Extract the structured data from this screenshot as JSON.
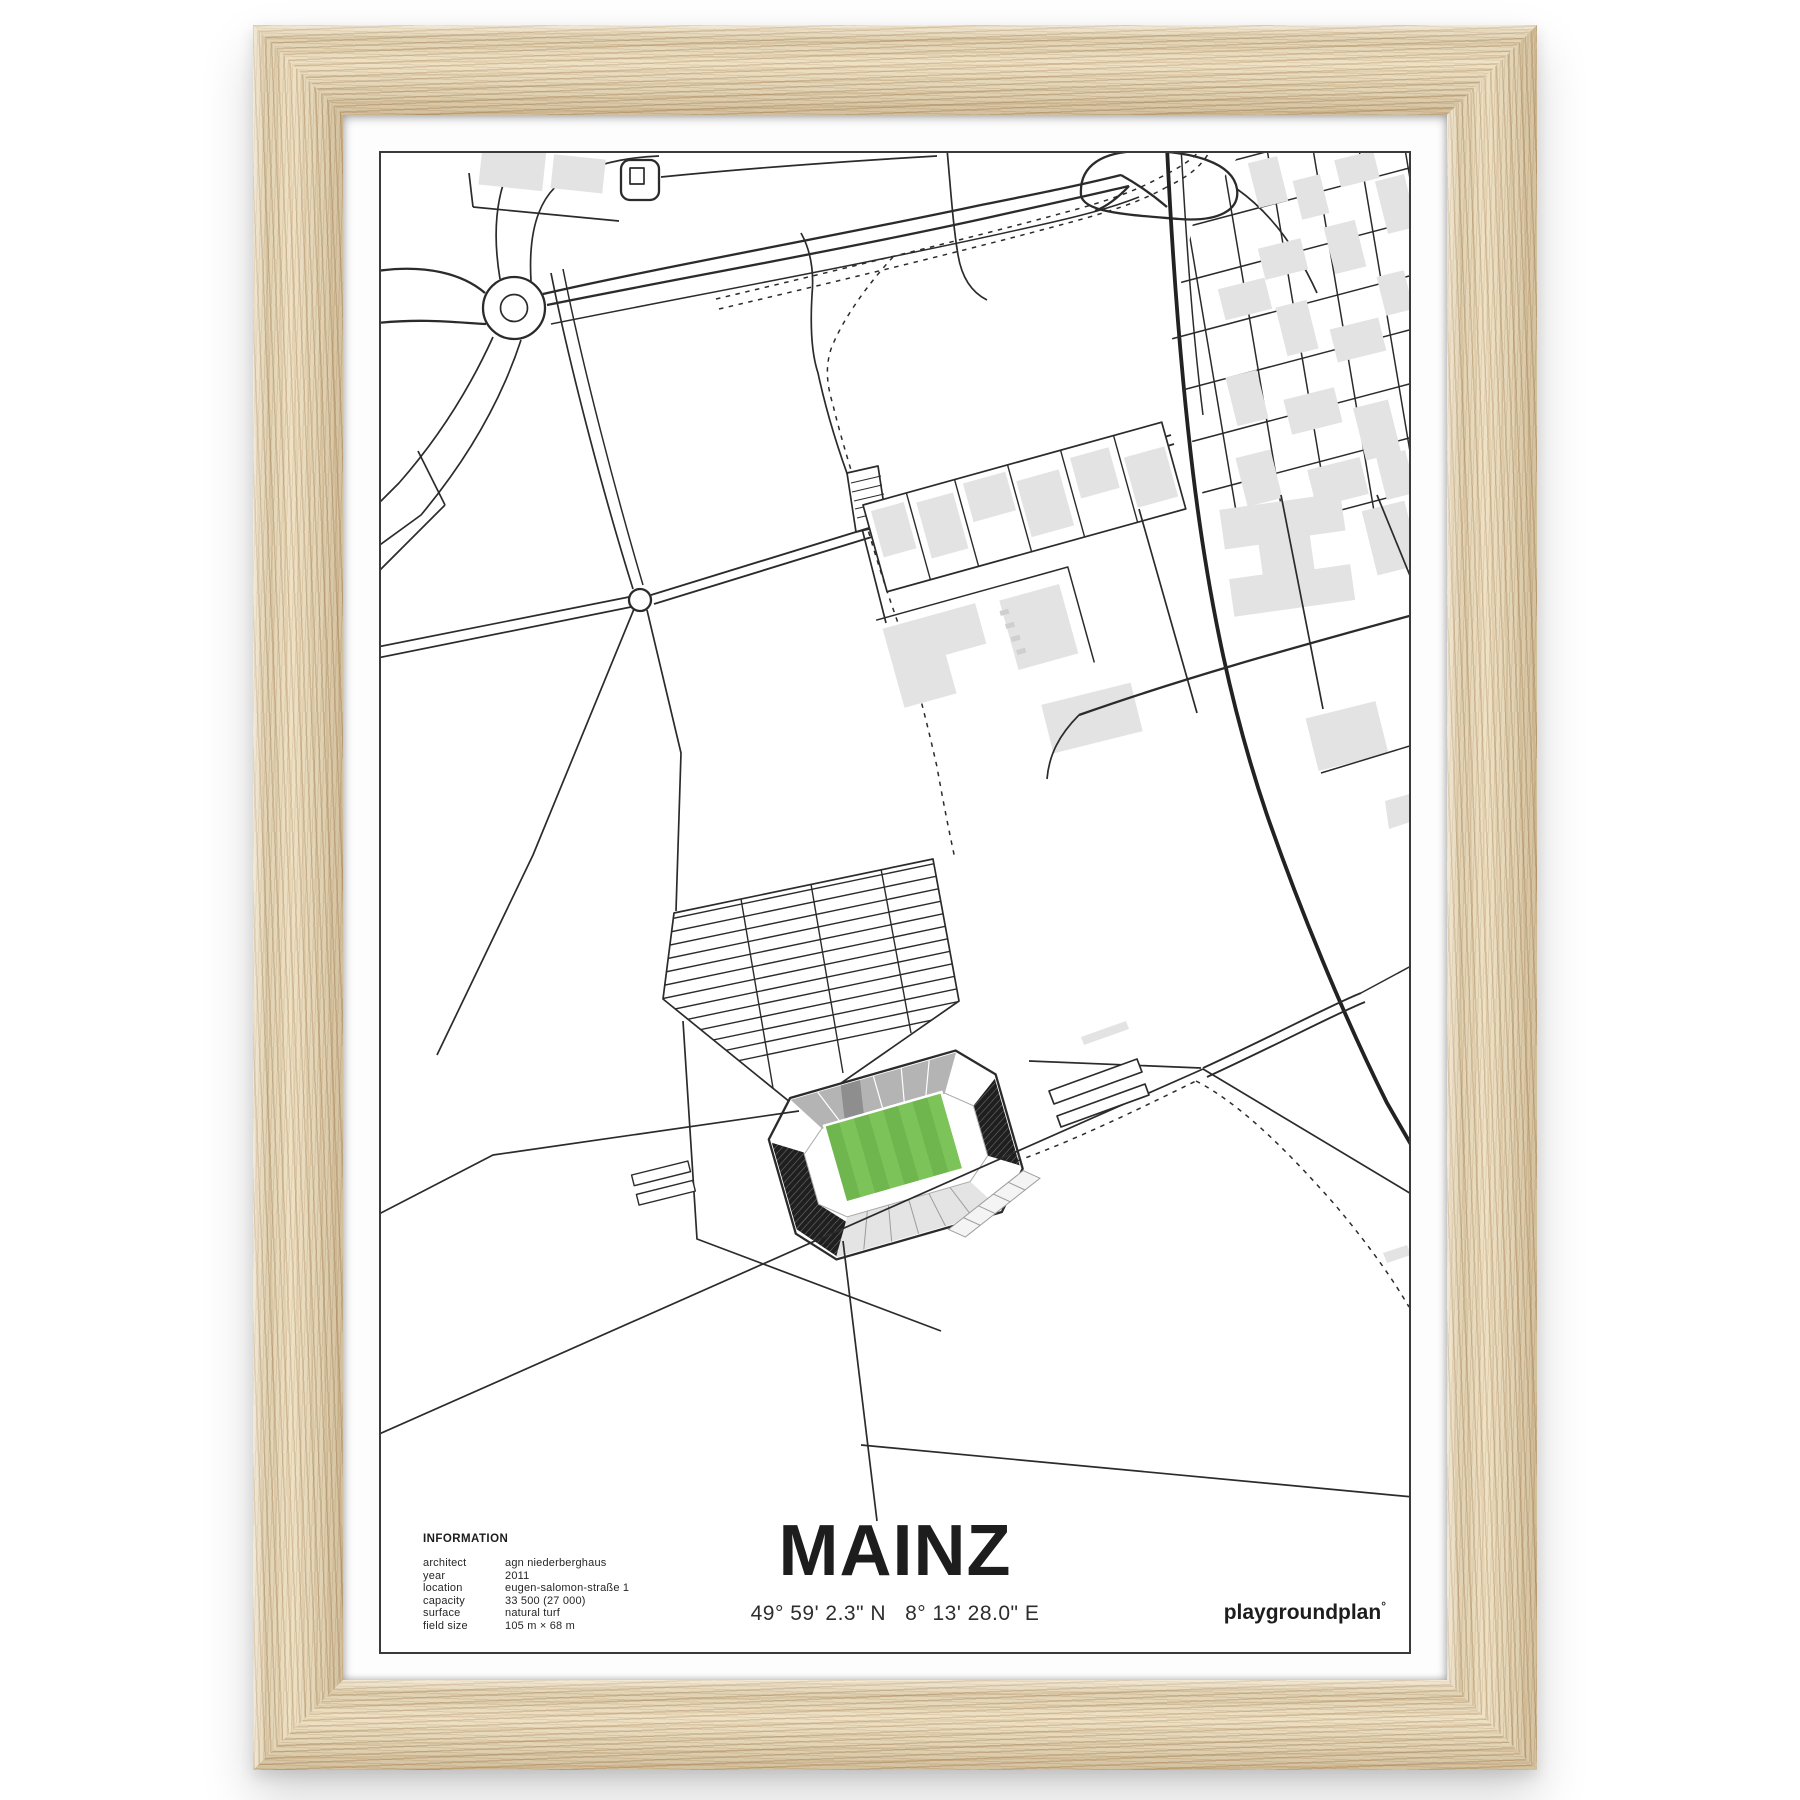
{
  "poster": {
    "title": "MAINZ",
    "coordinates": "49° 59' 2.3\" N   8° 13' 28.0\" E",
    "brand": "playgroundplan",
    "brand_mark": "°",
    "information": {
      "heading": "INFORMATION",
      "rows": [
        {
          "label": "architect",
          "value": "agn niederberghaus"
        },
        {
          "label": "year",
          "value": "2011"
        },
        {
          "label": "location",
          "value": "eugen-salomon-straße 1"
        },
        {
          "label": "capacity",
          "value": "33 500 (27 000)"
        },
        {
          "label": "surface",
          "value": "natural turf"
        },
        {
          "label": "field size",
          "value": "105 m × 68 m"
        }
      ]
    },
    "map_colors": {
      "line": "#2b2b2b",
      "building_fill": "#e3e3e3",
      "pitch_green": "#7cc35a",
      "pitch_stripe": "#6fb64e",
      "stand_dark": "#1f1f1f",
      "stand_gray": "#b4b4b4"
    },
    "frame_color": "#ecddbc"
  }
}
